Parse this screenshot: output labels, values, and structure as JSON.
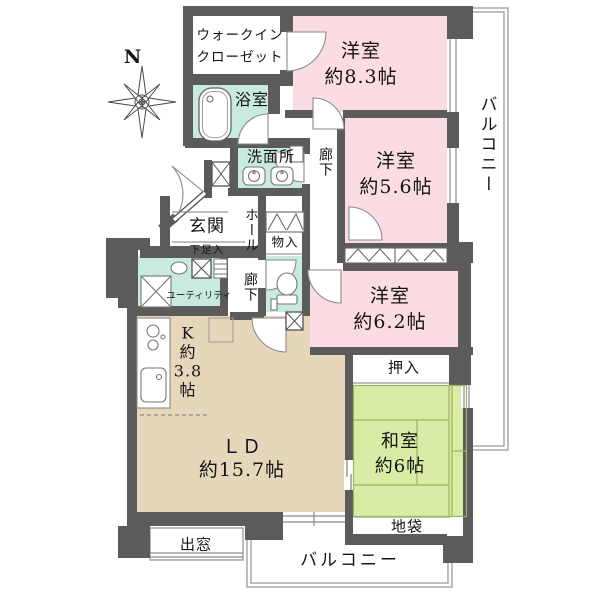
{
  "plan_title": "apartment-floorplan",
  "compass": {
    "north_label": "N"
  },
  "rooms": {
    "walk_in_closet": {
      "label": "ウォークイン\nクローゼット"
    },
    "bathroom": {
      "label": "浴室"
    },
    "washroom": {
      "label": "洗面所"
    },
    "corridor_upper": {
      "label": "廊下"
    },
    "hall": {
      "label": "ホール"
    },
    "corridor_lower": {
      "label": "廊下"
    },
    "entrance": {
      "label": "玄関"
    },
    "shoe_cabinet": {
      "label": "下足入"
    },
    "storage": {
      "label": "物入"
    },
    "utility": {
      "label": "ユーティリティ"
    },
    "kitchen": {
      "label": "K\n約\n3.8\n帖"
    },
    "living_dining": {
      "label": "ＬＤ\n約15.7帖"
    },
    "western_room_1": {
      "label": "洋室\n約8.3帖"
    },
    "western_room_2": {
      "label": "洋室\n約5.6帖"
    },
    "western_room_3": {
      "label": "洋室\n約6.2帖"
    },
    "japanese_room": {
      "label": "和室\n約6帖"
    },
    "oshiire_closet": {
      "label": "押入"
    },
    "jibukuro_cabinet": {
      "label": "地袋"
    },
    "bay_window": {
      "label": "出窓"
    },
    "balcony_right": {
      "label": "バルコニー"
    },
    "balcony_bottom": {
      "label": "バルコニー"
    }
  },
  "colors": {
    "wall": "#5b5b5b",
    "pink": "#fbdce3",
    "mint": "#c9eae1",
    "beige": "#e7d7ba",
    "tatami": "#d9eca6",
    "line": "#8c8c8c"
  }
}
